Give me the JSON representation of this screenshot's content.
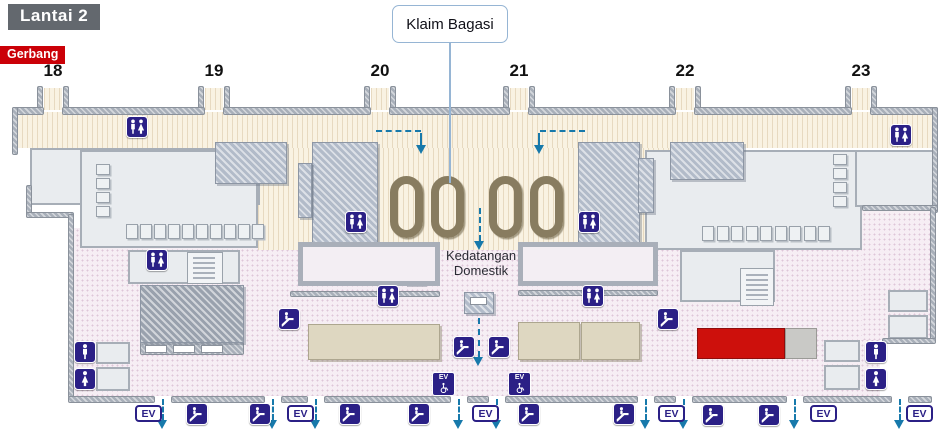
{
  "header": {
    "floor_label": "Lantai 2",
    "gate_label": "Gerbang",
    "baggage_callout": "Klaim Bagasi"
  },
  "gates": [
    {
      "label": "18",
      "x": 53
    },
    {
      "label": "19",
      "x": 214
    },
    {
      "label": "20",
      "x": 380
    },
    {
      "label": "21",
      "x": 519
    },
    {
      "label": "22",
      "x": 685
    },
    {
      "label": "23",
      "x": 861
    }
  ],
  "map": {
    "arrival_label": {
      "line1": "Kedatangan",
      "line2": "Domestik"
    },
    "ev_label": "EV",
    "icons": [
      {
        "type": "restroom-mf",
        "x": 126,
        "y": 116
      },
      {
        "type": "restroom-mf",
        "x": 890,
        "y": 124
      },
      {
        "type": "restroom-mf",
        "x": 345,
        "y": 211
      },
      {
        "type": "restroom-mf",
        "x": 578,
        "y": 211
      },
      {
        "type": "restroom-mf",
        "x": 146,
        "y": 249
      },
      {
        "type": "restroom-mf",
        "x": 377,
        "y": 285
      },
      {
        "type": "restroom-mf",
        "x": 582,
        "y": 285
      },
      {
        "type": "restroom-men",
        "x": 74,
        "y": 341
      },
      {
        "type": "restroom-women",
        "x": 74,
        "y": 368
      },
      {
        "type": "restroom-men",
        "x": 865,
        "y": 341
      },
      {
        "type": "restroom-women",
        "x": 865,
        "y": 368
      },
      {
        "type": "escalator",
        "x": 278,
        "y": 308
      },
      {
        "type": "escalator",
        "x": 657,
        "y": 308
      },
      {
        "type": "escalator",
        "x": 453,
        "y": 336
      },
      {
        "type": "escalator",
        "x": 488,
        "y": 336
      },
      {
        "type": "escalator",
        "x": 186,
        "y": 403
      },
      {
        "type": "escalator",
        "x": 249,
        "y": 403
      },
      {
        "type": "escalator",
        "x": 339,
        "y": 403
      },
      {
        "type": "escalator",
        "x": 408,
        "y": 403
      },
      {
        "type": "escalator",
        "x": 518,
        "y": 403
      },
      {
        "type": "escalator",
        "x": 613,
        "y": 403
      },
      {
        "type": "escalator",
        "x": 702,
        "y": 404
      },
      {
        "type": "escalator",
        "x": 758,
        "y": 404
      },
      {
        "type": "elevator-accessible",
        "x": 432,
        "y": 372
      },
      {
        "type": "elevator-accessible",
        "x": 508,
        "y": 372
      },
      {
        "type": "elevator",
        "x": 135,
        "y": 405
      },
      {
        "type": "elevator",
        "x": 287,
        "y": 405
      },
      {
        "type": "elevator",
        "x": 472,
        "y": 405
      },
      {
        "type": "elevator",
        "x": 658,
        "y": 405
      },
      {
        "type": "elevator",
        "x": 810,
        "y": 405
      },
      {
        "type": "elevator",
        "x": 906,
        "y": 405
      }
    ],
    "carousels": [
      {
        "x": 390,
        "y": 176
      },
      {
        "x": 431,
        "y": 176
      },
      {
        "x": 489,
        "y": 176
      },
      {
        "x": 530,
        "y": 176
      }
    ],
    "flow_arrows_down": [
      {
        "x": 480,
        "y": 208,
        "len": 42
      },
      {
        "x": 479,
        "y": 318,
        "len": 48
      },
      {
        "x": 163,
        "y": 399,
        "len": 30
      },
      {
        "x": 273,
        "y": 399,
        "len": 30
      },
      {
        "x": 316,
        "y": 399,
        "len": 30
      },
      {
        "x": 459,
        "y": 399,
        "len": 30
      },
      {
        "x": 497,
        "y": 399,
        "len": 30
      },
      {
        "x": 646,
        "y": 399,
        "len": 30
      },
      {
        "x": 684,
        "y": 399,
        "len": 30
      },
      {
        "x": 795,
        "y": 399,
        "len": 30
      },
      {
        "x": 900,
        "y": 399,
        "len": 30
      }
    ],
    "flow_elbows": [
      {
        "hx": 376,
        "hy": 130,
        "hw": 45,
        "vx": 420,
        "vy": 133,
        "vh": 12
      },
      {
        "hx": 540,
        "hy": 130,
        "hw": 45,
        "vx": 538,
        "vy": 133,
        "vh": 12
      }
    ],
    "highlight": {
      "x": 697,
      "y": 328,
      "w": 88,
      "h": 31,
      "color": "#cd100c"
    }
  },
  "colors": {
    "navy": "#2b2086",
    "blue": "#1779ab",
    "red": "#cd100c",
    "gerbang_red": "#cb0007",
    "floor_gray": "#63686e",
    "carousel": "#887c60",
    "callout_border": "#96b5d4"
  }
}
